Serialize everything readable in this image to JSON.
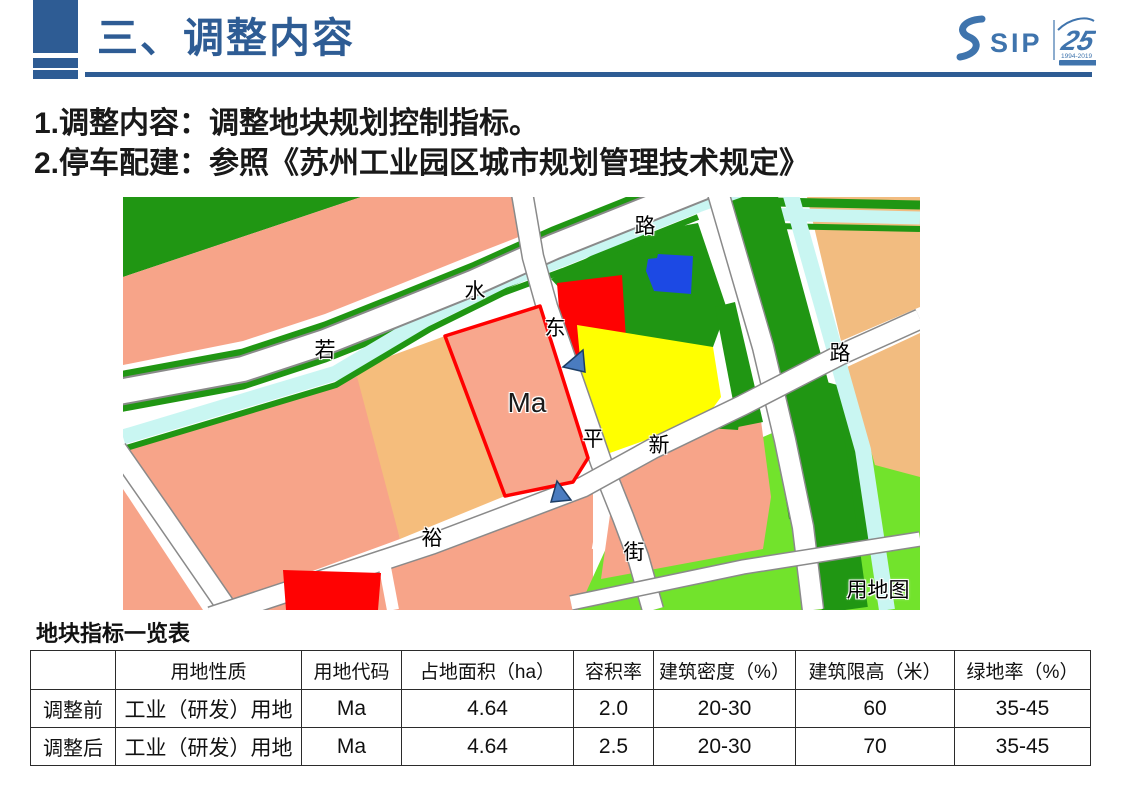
{
  "header": {
    "title": "三、调整内容",
    "accent_color": "#2e5c94"
  },
  "logo": {
    "sip_text": "SIP",
    "anniversary_number": "25",
    "anniversary_years": "1994-2019",
    "color": "#3f74ad"
  },
  "intro": {
    "lines": [
      "1.调整内容：调整地块规划控制指标。",
      "2.停车配建：参照《苏州工业园区城市规划管理技术规定》"
    ]
  },
  "map": {
    "caption": "用地图",
    "plot_label": "Ma",
    "street_labels": [
      {
        "text": "路"
      },
      {
        "text": "水"
      },
      {
        "text": "若"
      },
      {
        "text": "东"
      },
      {
        "text": "平"
      },
      {
        "text": "新"
      },
      {
        "text": "裕"
      },
      {
        "text": "街"
      },
      {
        "text": "路"
      }
    ],
    "colors": {
      "salmon_parcel": "#f7a489",
      "orange_parcel": "#f5bd7c",
      "peach_parcel": "#f2bc80",
      "dark_green": "#209613",
      "bright_green": "#72e32c",
      "canal_cyan": "#c9f6f2",
      "red_parcel": "#ff0202",
      "yellow_parcel": "#ffff00",
      "blue_building": "#1c49e4",
      "plot_outline_red": "#ff0000",
      "road_white": "#ffffff"
    }
  },
  "table": {
    "title": "地块指标一览表",
    "columns": [
      "",
      "用地性质",
      "用地代码",
      "占地面积（ha）",
      "容积率",
      "建筑密度（%）",
      "建筑限高（米）",
      "绿地率（%）"
    ],
    "rows": [
      [
        "调整前",
        "工业（研发）用地",
        "Ma",
        "4.64",
        "2.0",
        "20-30",
        "60",
        "35-45"
      ],
      [
        "调整后",
        "工业（研发）用地",
        "Ma",
        "4.64",
        "2.5",
        "20-30",
        "70",
        "35-45"
      ]
    ]
  }
}
